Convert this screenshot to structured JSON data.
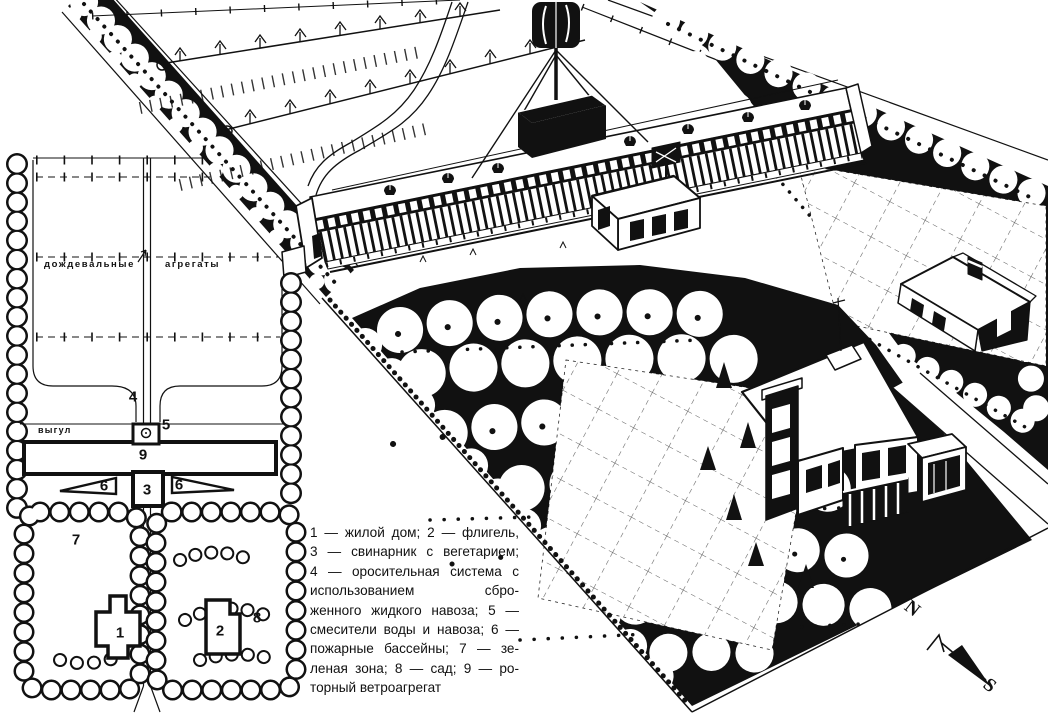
{
  "colors": {
    "ink": "#111111",
    "paper": "#ffffff"
  },
  "legend": {
    "lines": [
      "1 — жилой дом; 2 — флигель,",
      "3 — свинарник с вегетарием;",
      "4 — оросительная система с",
      "использованием сбро-",
      "женного жидкого навоза; 5 —",
      "смесители воды и навоза; 6 —",
      "пожарные бассейны; 7 — зе-",
      "леная зона; 8 — сад; 9 — ро-",
      "торный ветроагрегат"
    ]
  },
  "plan": {
    "irrigation_label_word1": "дождевальные",
    "irrigation_label_word2": "агрегаты",
    "paddock_label": "выгул",
    "markers": {
      "m1": "1",
      "m2": "2",
      "m3": "3",
      "m4": "4",
      "m5": "5",
      "m6a": "6",
      "m6b": "6",
      "m7": "7",
      "m8": "8",
      "m9": "9"
    }
  },
  "compass": {
    "north": "N",
    "south": "S"
  }
}
